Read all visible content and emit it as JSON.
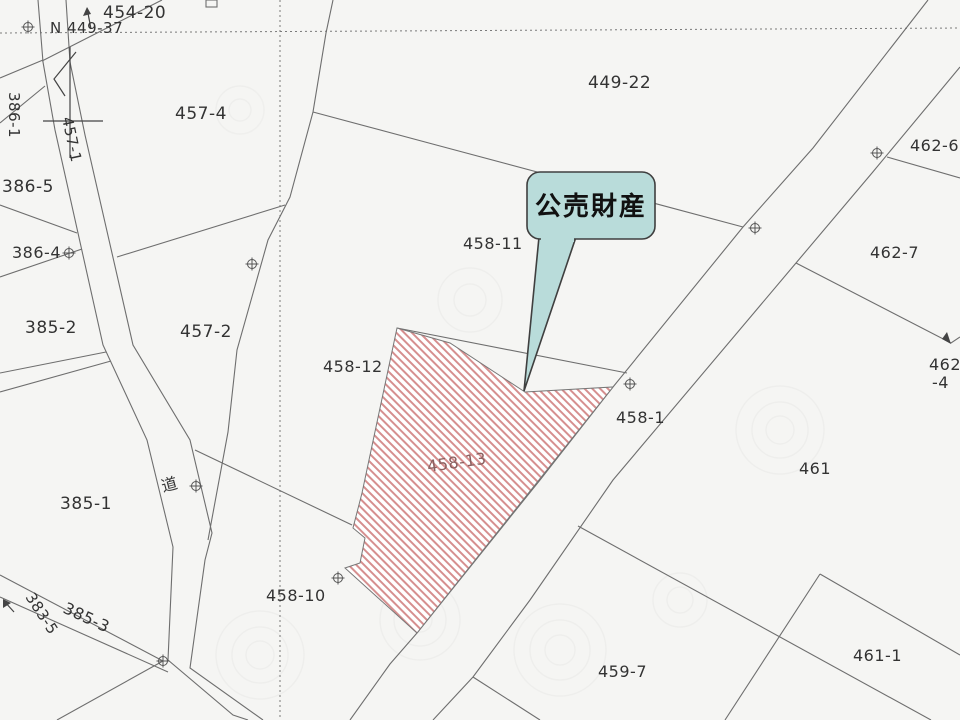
{
  "map": {
    "title": "cadastral parcel map",
    "callout": {
      "label": "公売財産",
      "fill": "#b9dcda",
      "border": "#3f3f3f",
      "points_to_parcel": "458-13"
    },
    "highlight": {
      "parcel": "458-13",
      "stripe_color": "#d68f8f",
      "style": "diagonal-hatch"
    },
    "labels": {
      "p454_20": "454-20",
      "n449_37": "N 449-37",
      "p449_22": "449-22",
      "p457_4": "457-4",
      "p457_2": "457-2",
      "p457_1": "457-1",
      "p462_6": "462-6",
      "p462_7": "462-7",
      "p462_4_line1": "462",
      "p462_4_line2": "-4",
      "p386_1": "386-1",
      "p386_5": "386-5",
      "p386_4": "386-4",
      "p385_2": "385-2",
      "p385_1": "385-1",
      "p385_3": "385-3",
      "p383_5": "383-5",
      "p458_11": "458-11",
      "p458_12": "458-12",
      "p458_13": "458-13",
      "p458_10": "458-10",
      "p458_1": "458-1",
      "p459_7": "459-7",
      "p461": "461",
      "p461_1": "461-1",
      "road": "道"
    },
    "colors": {
      "background": "#f5f5f3",
      "boundary_line": "#6e6e6e",
      "label_text": "#333333",
      "hatch_label_text": "#8a5f5f"
    }
  }
}
